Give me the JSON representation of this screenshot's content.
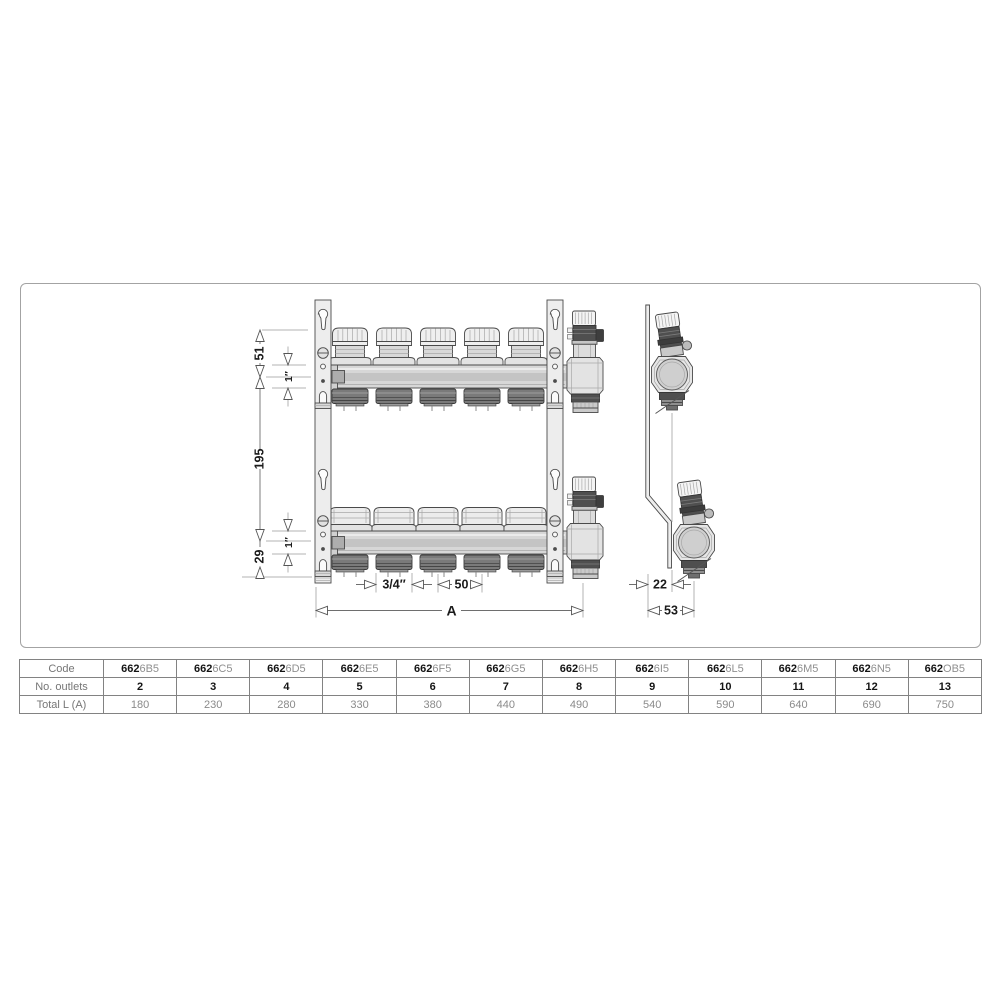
{
  "diagram": {
    "dimensions": {
      "bracket_top_to_axis": "51",
      "pipe_size_top": "1″",
      "axis_spacing": "195",
      "axis_to_bracket_bottom": "29",
      "pipe_size_bottom": "1″",
      "outlet_size": "3/4″",
      "outlet_spacing": "50",
      "total_length": "A",
      "depth_offset": "22",
      "depth_total": "53"
    }
  },
  "table": {
    "code_prefix": "662",
    "rows": {
      "code": "Code",
      "outlets": "No. outlets",
      "total": "Total L (A)"
    },
    "columns": [
      {
        "code_suffix": "6B5",
        "outlets": "2",
        "total": "180"
      },
      {
        "code_suffix": "6C5",
        "outlets": "3",
        "total": "230"
      },
      {
        "code_suffix": "6D5",
        "outlets": "4",
        "total": "280"
      },
      {
        "code_suffix": "6E5",
        "outlets": "5",
        "total": "330"
      },
      {
        "code_suffix": "6F5",
        "outlets": "6",
        "total": "380"
      },
      {
        "code_suffix": "6G5",
        "outlets": "7",
        "total": "440"
      },
      {
        "code_suffix": "6H5",
        "outlets": "8",
        "total": "490"
      },
      {
        "code_suffix": "6I5",
        "outlets": "9",
        "total": "540"
      },
      {
        "code_suffix": "6L5",
        "outlets": "10",
        "total": "590"
      },
      {
        "code_suffix": "6M5",
        "outlets": "11",
        "total": "640"
      },
      {
        "code_suffix": "6N5",
        "outlets": "12",
        "total": "690"
      },
      {
        "code_suffix": "OB5",
        "outlets": "13",
        "total": "750"
      }
    ]
  }
}
